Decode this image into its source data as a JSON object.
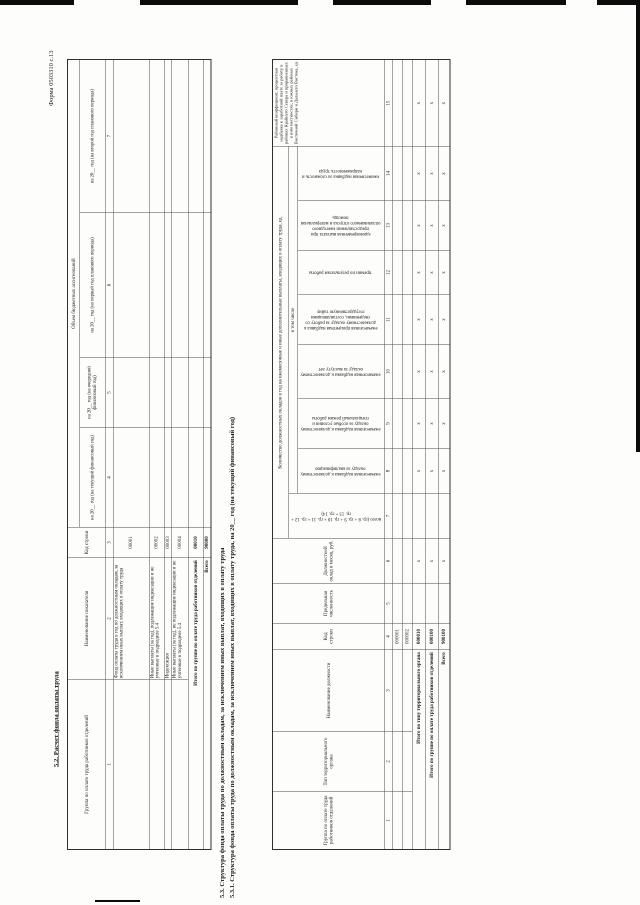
{
  "page": {
    "form_label": "Форма 0503310 с.13",
    "section_5_2_title": "5.2. Расчет фонда оплаты труда",
    "section_5_3_title": "5.3. Структура фонда оплаты труда по должностным окладам, за исключением иных выплат, входящих в оплату труда",
    "section_5_3_1_title": "5.3.1. Структура фонда оплаты труда по должностным окладам, за исключением иных выплат, входящих в оплату труда, на 20__ год (на текущий финансовый год)"
  },
  "colors": {
    "ink": "#1c1c1c",
    "line": "#4a4a4a"
  },
  "table1": {
    "group_header": "Объем бюджетных ассигнований",
    "columns": [
      {
        "label": "Группа по оплате труда работников отделений",
        "num": "1"
      },
      {
        "label": "Наименование показателя",
        "num": "2"
      },
      {
        "label": "Код строки",
        "num": "3"
      },
      {
        "label": "на 20__ год (на текущий финансовый год)",
        "num": "4"
      },
      {
        "label": "на 20__ год (на очередной финансовый год)",
        "num": "5"
      },
      {
        "label": "на 20__ год (на первый год планового периода)",
        "num": "6"
      },
      {
        "label": "на 20__ год (на второй год планового периода)",
        "num": "7"
      }
    ],
    "rows": [
      {
        "name": "Фонд оплаты труда в год по должностным окладам, за исключением иных выплат, входящих в оплату труда",
        "code": "00001"
      },
      {
        "name": "Иные выплаты (за год), подлежащие индексации и не учтенные в подразделе 5.4",
        "code": "00002"
      },
      {
        "name": "Индексация",
        "code": "00003"
      },
      {
        "name": "Иные выплаты (за год), не подлежащие индексации и не учтенные в подразделе 5.4",
        "code": "00004"
      },
      {
        "name": "Итого по группе по оплате труда работников отделений",
        "code": "00010"
      },
      {
        "name": "Всего",
        "code": "90000"
      }
    ]
  },
  "table2": {
    "group_header": "Количество должностных окладов в год на ежемесячные и иные дополнительные выплаты, входящих в оплату труда, ед.",
    "subgroup_header": "в том числе",
    "columns": [
      {
        "label": "Группа по оплате труда работников отделений",
        "num": "1"
      },
      {
        "label": "Тип территориального органа",
        "num": "2"
      },
      {
        "label": "Наименование должности",
        "num": "3"
      },
      {
        "label": "Код строки",
        "num": "4"
      },
      {
        "label": "Предельная численность",
        "num": "5"
      },
      {
        "label": "Должностной оклад в месяц, руб.",
        "num": "6"
      },
      {
        "label": "всего (гр. 8 + гр. 9 + гр. 10 + гр. 11 + гр. 12 + гр. 13 + гр. 14)",
        "num": "7"
      },
      {
        "label": "ежемесячная надбавка к должностному окладу за квалификацию",
        "num": "8"
      },
      {
        "label": "ежемесячная надбавка к должностному окладу за особые условия и специальный режим работы",
        "num": "9"
      },
      {
        "label": "ежемесячная надбавка к должностному окладу за выслугу лет",
        "num": "10"
      },
      {
        "label": "ежемесячная процентная надбавка к должностному окладу за работу со сведениями, составляющими государственную тайну",
        "num": "11"
      },
      {
        "label": "премии по результатам работы",
        "num": "12"
      },
      {
        "label": "единовременная выплата при предоставлении ежегодного оплачиваемого отпуска и материальная помощь",
        "num": "13"
      },
      {
        "label": "ежемесячная надбавка за сложность и напряженность труда",
        "num": "14"
      },
      {
        "label": "Районный коэффициент, процентная надбавка к заработной плате за работу в районах Крайнего Севера и приравненных к ним местностях, в южных районах Восточной Сибири и Дальнего Востока, ед",
        "num": "15"
      }
    ],
    "data_rows": [
      {
        "code": "000001"
      },
      {
        "code": "000002"
      }
    ],
    "total_rows": [
      {
        "label": "Итого по типу территориального органа",
        "code": "000010"
      },
      {
        "label": "Итого по группе по оплате труда работников отделений",
        "code": "000100"
      },
      {
        "label": "Всего",
        "code": "900100"
      }
    ],
    "x_mark": "x"
  }
}
